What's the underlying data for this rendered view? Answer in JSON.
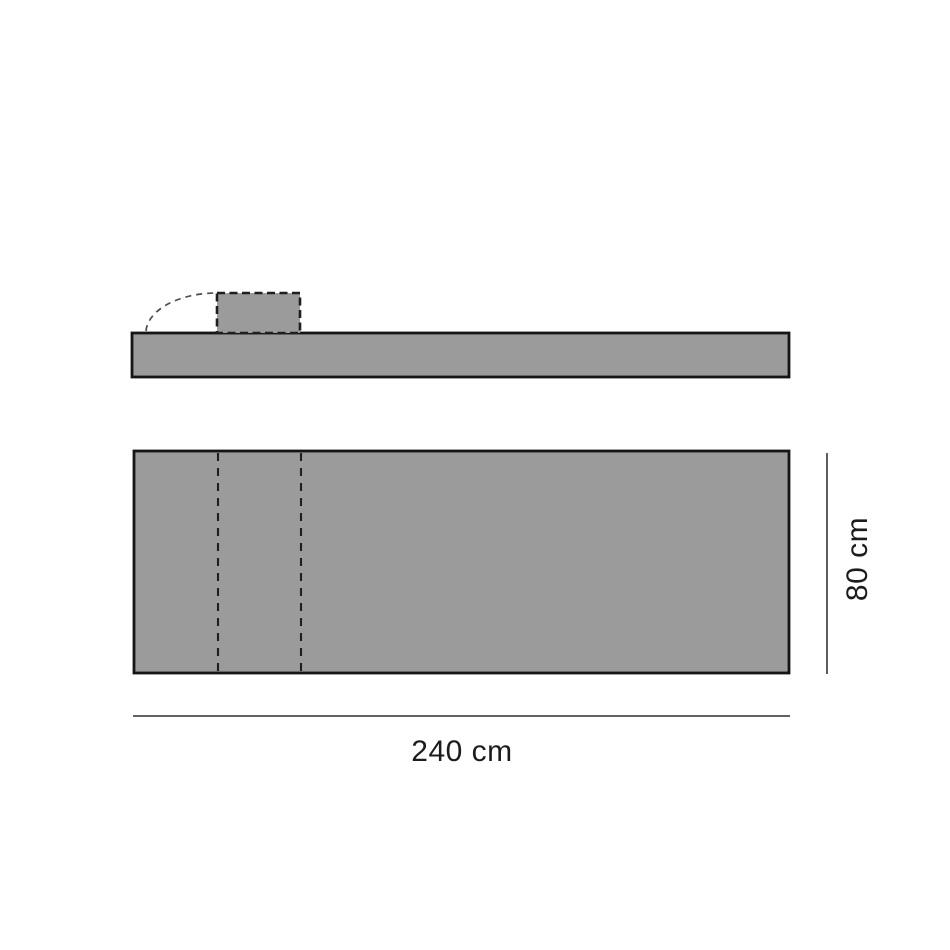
{
  "diagram": {
    "kind": "furniture-dimension-drawing",
    "dimensions": {
      "width": {
        "value": 240,
        "unit": "cm",
        "label": "240 cm"
      },
      "depth": {
        "value": 80,
        "unit": "cm",
        "label": "80 cm"
      }
    },
    "colors": {
      "panel_fill": "#9B9B9B",
      "outline": "#151515",
      "dashed_detail": "#1F1F1F",
      "dimension_line": "#4D4D4D",
      "label_text": "#1C1C1C",
      "background": "#FFFFFF"
    }
  }
}
